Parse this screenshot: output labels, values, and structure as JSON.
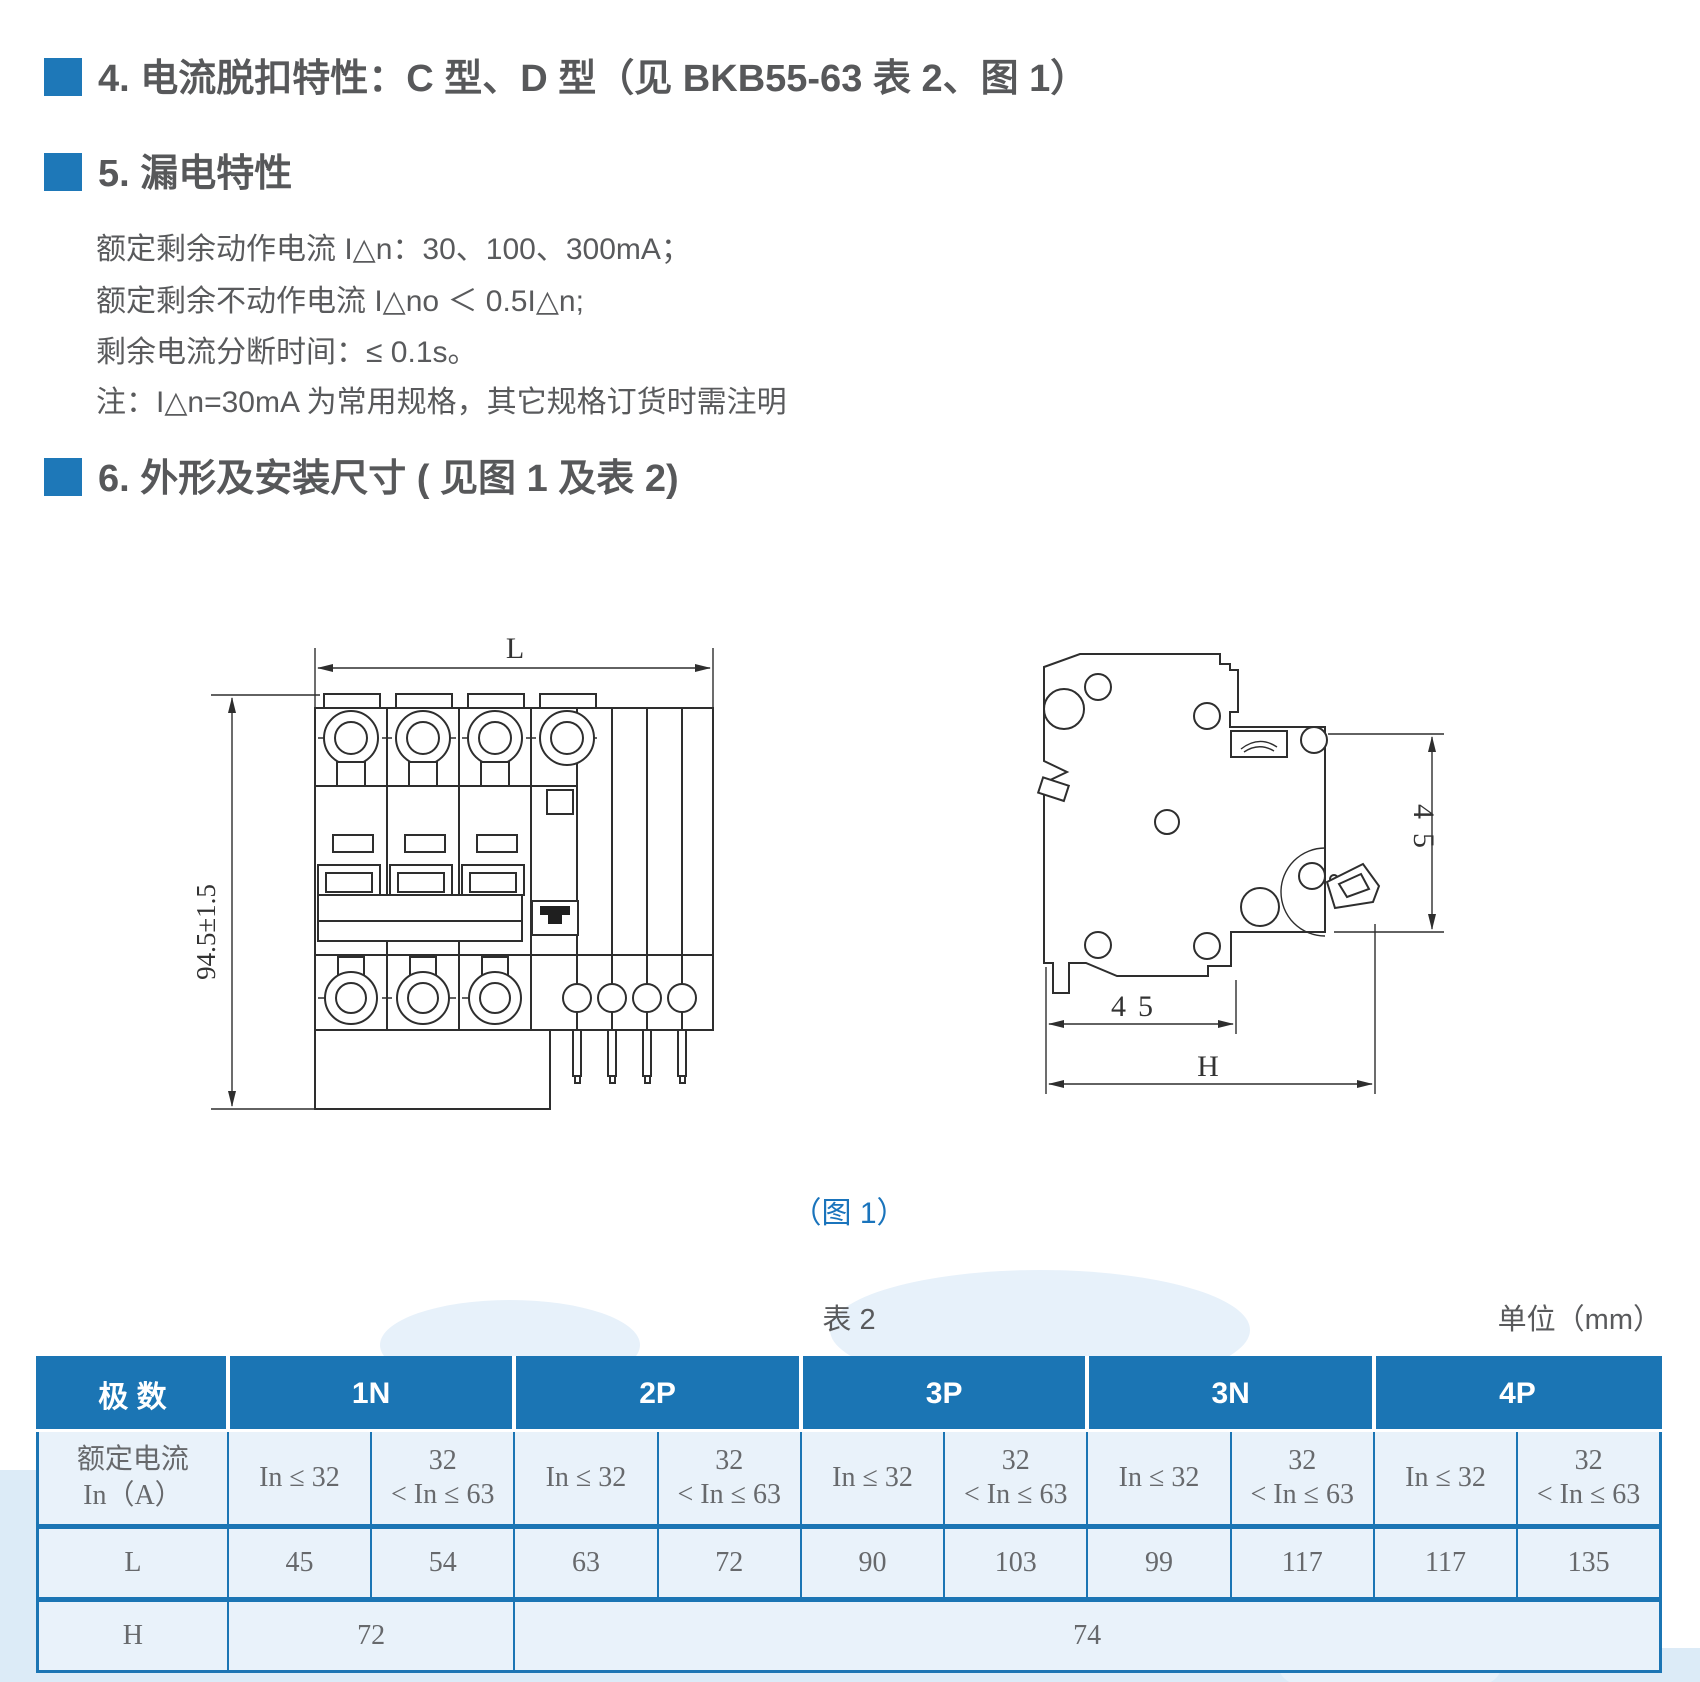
{
  "colors": {
    "accent_blue": "#1e78b8",
    "table_header_blue": "#1b75b4",
    "caption_blue": "#1a74bc",
    "heading_text": "#57585a",
    "body_text": "#595a5c",
    "cell_bg": "#e9f2fa"
  },
  "sections": {
    "s4": {
      "title": "4. 电流脱扣特性：C 型、D 型（见 BKB55-63 表 2、图 1）"
    },
    "s5": {
      "title": "5. 漏电特性",
      "lines": [
        "额定剩余动作电流 I△n：30、100、300mA；",
        "额定剩余不动作电流 I△no ＜ 0.5I△n;",
        "剩余电流分断时间：≤ 0.1s。",
        "注：I△n=30mA 为常用规格，其它规格订货时需注明"
      ]
    },
    "s6": {
      "title": "6. 外形及安装尺寸 ( 见图 1 及表 2)"
    }
  },
  "figure": {
    "caption": "（图 1）",
    "front_view": {
      "width_label": "L",
      "height_label": "94.5±1.5"
    },
    "side_view": {
      "depth_label": "45",
      "bottom_label": "45",
      "height_label": "H"
    }
  },
  "table": {
    "title": "表 2",
    "unit": "单位（mm）",
    "col0_header": "极 数",
    "groups": [
      "1N",
      "2P",
      "3P",
      "3N",
      "4P"
    ],
    "current_label": [
      "额定电流",
      "In（A）"
    ],
    "range_low": "In ≤ 32",
    "range_high": [
      "32",
      "< In ≤ 63"
    ],
    "row_L_label": "L",
    "row_L": [
      "45",
      "54",
      "63",
      "72",
      "90",
      "103",
      "99",
      "117",
      "117",
      "135"
    ],
    "row_H_label": "H",
    "row_H": [
      "72",
      "74"
    ]
  }
}
